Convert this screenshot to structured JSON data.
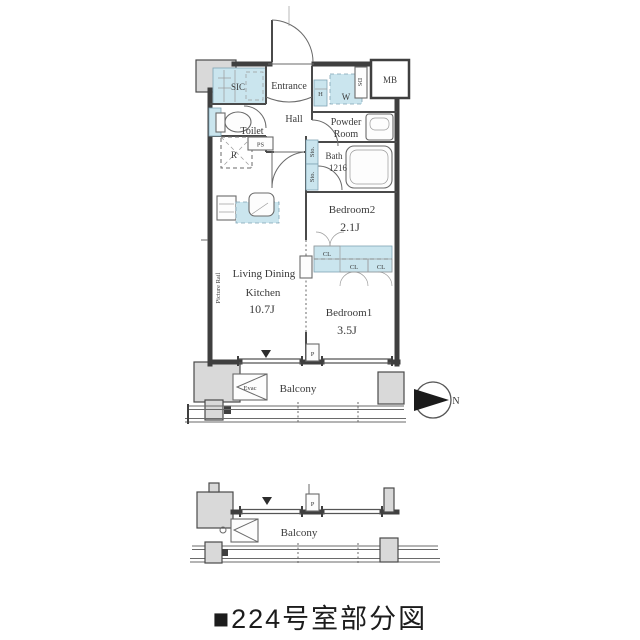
{
  "caption": "■224号室部分図",
  "colors": {
    "closet_fill": "#cae5ee",
    "column_fill": "#d9d9d9",
    "wall": "#3f3f3f",
    "text": "#3a3a3a"
  },
  "plan": {
    "rooms": {
      "sic": "SIC",
      "entrance": "Entrance",
      "hall": "Hall",
      "toilet": "Toilet",
      "powder_line1": "Powder",
      "powder_line2": "Room",
      "bath": "Bath",
      "bath_size": "1216",
      "bedroom2": "Bedroom2",
      "bedroom2_size": "2.1J",
      "ldk_line1": "Living Dining",
      "ldk_line2": "Kitchen",
      "ldk_size": "10.7J",
      "bedroom1": "Bedroom1",
      "bedroom1_size": "3.5J",
      "balcony": "Balcony"
    },
    "small_labels": {
      "h": "H",
      "w": "W",
      "ds": "DS",
      "mb": "MB",
      "ps": "PS",
      "fridge": "R",
      "sto_upper": "Sto.",
      "sto_lower": "Sto.",
      "cl_1": "CL",
      "cl_2": "CL",
      "cl_3": "CL",
      "pillar": "P",
      "evac": "Evac",
      "picture_rail": "Picture Rail"
    }
  },
  "lower_plan": {
    "balcony": "Balcony",
    "pillar": "P"
  },
  "compass": {
    "north": "N"
  }
}
